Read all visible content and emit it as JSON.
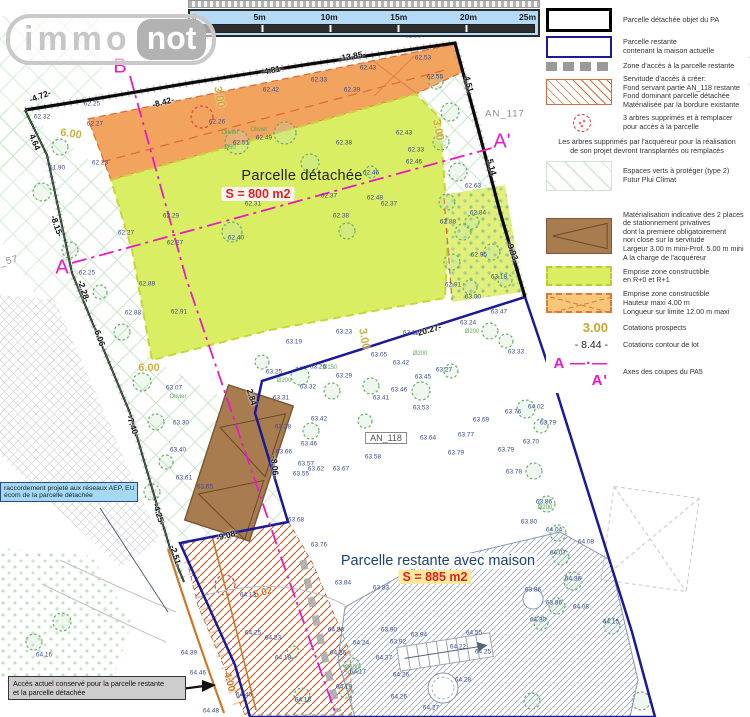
{
  "logo": {
    "immo": "immo",
    "not": "not"
  },
  "scalebar": {
    "ticks": [
      "0",
      "5m",
      "10m",
      "15m",
      "20m",
      "25m"
    ]
  },
  "colors": {
    "detached_boundary": "#000000",
    "remaining_boundary": "#1a1a99",
    "axis_magenta": "#ea18c8",
    "emprise_green": "#d9ee63",
    "emprise_orange": "#f2a35e",
    "servitude_hatch": "#c06838",
    "parking_brown": "#a97c50",
    "prospect_gold": "#c9a62e",
    "spot_blue": "#3c4e8f",
    "area_red": "#e02020"
  },
  "legend": {
    "items": [
      {
        "type": "black",
        "lines": [
          "Parcelle détachée objet du PA"
        ]
      },
      {
        "type": "blue",
        "lines": [
          "Parcelle restante",
          "contenant la maison actuelle"
        ]
      },
      {
        "type": "graydash",
        "lines": [
          "Zone d'accès à la parcelle restante"
        ]
      },
      {
        "type": "hatch",
        "lines": [
          "Servitude d'accès à créer:",
          "Fond servant partie AN_118 restante",
          "Fond dominant parcelle détachée",
          "Matérialisée par la bordure existante"
        ]
      },
      {
        "type": "treered",
        "lines": [
          "3 arbres supprimés et à remplacer",
          "pour accès à la parcelle"
        ]
      },
      {
        "type": "note",
        "lines": [
          "Les arbres supprimés par l'acquéreur pour la réalisation",
          "de son projet devront transplantés ou remplacés"
        ]
      },
      {
        "type": "diamond",
        "gap": true,
        "lines": [
          "Espaces verts à protéger (type 2)",
          "Futur Plui Climat"
        ]
      },
      {
        "type": "parking",
        "lines": [
          "Matérialisation indicative des 2 places",
          "de stationnement privatives",
          "dont la premiere obligatoirement",
          "non close sur la servitude",
          "Largeur 3.00 m mini-Prof. 5.00 m mini",
          "A la charge de l'acquéreur"
        ]
      },
      {
        "type": "greendash",
        "lines": [
          "Emprise zone constructible",
          "en R+0 et R+1"
        ]
      },
      {
        "type": "orangex",
        "lines": [
          "Emprise zone constructible",
          "Hauteur maxi 4.00 m",
          "Longueur sur limite 12.00 m maxi"
        ]
      },
      {
        "type": "gold3",
        "label": "3.00",
        "lines": [
          "Cotations prospects"
        ]
      },
      {
        "type": "cot844",
        "label": "- 8.44 -",
        "lines": [
          "Cotations contour de lot"
        ]
      },
      {
        "type": "axis",
        "label": "A —·— A'",
        "lines": [
          "Axes des coupes du PA5"
        ]
      }
    ]
  },
  "callouts": {
    "network": {
      "lines": [
        "raccordement projeté aux réseaux AEP, EU",
        "écom de la parcelle détachée"
      ]
    },
    "access": {
      "lines": [
        "Accès actuel conservé pour la parcelle restante",
        "et la parcelle détachée"
      ]
    }
  },
  "plan": {
    "labels": [
      [
        "B",
        120,
        67,
        "mag",
        0
      ],
      [
        "A",
        62,
        268,
        "mag",
        0
      ],
      [
        "A'",
        502,
        142,
        "mag",
        0
      ],
      [
        "AN_107",
        280,
        30,
        "pid",
        0
      ],
      [
        "AN_117",
        505,
        114,
        "pid",
        0
      ],
      [
        "AN_57",
        2,
        263,
        "pid",
        -15
      ],
      [
        "AN_118",
        386,
        438,
        "pidbox",
        0
      ],
      [
        "Parcelle détachée",
        302,
        176,
        "t1",
        0
      ],
      [
        "S = 800 m2",
        258,
        194,
        "s1",
        0
      ],
      [
        "Parcelle restante avec maison",
        438,
        561,
        "t2",
        0
      ],
      [
        "S = 885 m2",
        435,
        577,
        "s2",
        0
      ],
      [
        "-4.72-",
        40,
        96,
        "cot",
        -20
      ],
      [
        "-8.42-",
        163,
        102,
        "cot",
        -14
      ],
      [
        "-4.81-",
        272,
        70,
        "cot",
        -11
      ],
      [
        "-13.85-",
        352,
        56,
        "cot",
        -10
      ],
      [
        "4.64",
        35,
        142,
        "cot",
        68
      ],
      [
        "-8.15-",
        57,
        226,
        "cot",
        71
      ],
      [
        "-2.28-",
        84,
        291,
        "cot",
        72
      ],
      [
        "-6.06-",
        100,
        338,
        "cot",
        70
      ],
      [
        "-7.40-",
        133,
        426,
        "cot",
        71
      ],
      [
        "-4.25-",
        159,
        514,
        "cot",
        73
      ],
      [
        "-2.51-",
        176,
        556,
        "cot",
        73
      ],
      [
        "4.51",
        469,
        84,
        "cot",
        76
      ],
      [
        "5.14",
        492,
        167,
        "cot",
        76
      ],
      [
        "-9.93-",
        513,
        252,
        "cot",
        70
      ],
      [
        "-20.27-",
        428,
        330,
        "cot",
        -16
      ],
      [
        "2.84",
        252,
        397,
        "cot",
        73
      ],
      [
        "-8.06-",
        275,
        467,
        "cot",
        84
      ],
      [
        "-9.08-",
        227,
        535,
        "cot",
        -14
      ],
      [
        "3.00",
        219,
        97,
        "gold",
        80
      ],
      [
        "3.00",
        438,
        130,
        "gold",
        80
      ],
      [
        "3.00",
        364,
        339,
        "gold",
        80
      ],
      [
        "6.00",
        71,
        134,
        "gold",
        8
      ],
      [
        "6.00",
        149,
        368,
        "gold",
        0
      ],
      [
        "4.00",
        229,
        682,
        "ocot",
        75
      ],
      [
        "5.02",
        263,
        593,
        "ocot",
        -15
      ],
      [
        "Olivier",
        230,
        133,
        "tl",
        0
      ],
      [
        "Olivier",
        259,
        130,
        "tl",
        0
      ],
      [
        "Olivier",
        178,
        397,
        "tl",
        0
      ],
      [
        "Ø50",
        230,
        148,
        "tl",
        0
      ],
      [
        "Ø150",
        330,
        368,
        "tl",
        0
      ],
      [
        "Ø200",
        284,
        381,
        "tl",
        0
      ],
      [
        "Ø200",
        472,
        332,
        "tl",
        0
      ],
      [
        "Ø100",
        352,
        668,
        "tl",
        0
      ],
      [
        "Ø200",
        545,
        508,
        "tl",
        0
      ],
      [
        "Ø200",
        420,
        354,
        "tl",
        0
      ],
      [
        "62.32",
        42,
        117,
        "spot",
        0
      ],
      [
        "62.25",
        92,
        104,
        "spot",
        0
      ],
      [
        "62.27",
        95,
        124,
        "spot",
        0
      ],
      [
        "62.23",
        100,
        163,
        "spot",
        0
      ],
      [
        "61.90",
        57,
        168,
        "spot",
        0
      ],
      [
        "62.29",
        171,
        216,
        "spot",
        0
      ],
      [
        "62.27",
        126,
        233,
        "spot",
        0
      ],
      [
        "62.27",
        175,
        243,
        "spot",
        0
      ],
      [
        "62.25",
        87,
        273,
        "spot",
        0
      ],
      [
        "62.88",
        147,
        284,
        "spot",
        0
      ],
      [
        "62.88",
        133,
        313,
        "spot",
        0
      ],
      [
        "62.91",
        179,
        312,
        "spot",
        0
      ],
      [
        "62.26",
        217,
        122,
        "spot",
        0
      ],
      [
        "62.51",
        241,
        143,
        "spot",
        0
      ],
      [
        "62.49",
        264,
        138,
        "spot",
        0
      ],
      [
        "62.58",
        413,
        36,
        "spot",
        0
      ],
      [
        "62.51",
        459,
        30,
        "spot",
        0
      ],
      [
        "62.53",
        423,
        58,
        "spot",
        0
      ],
      [
        "62.55",
        435,
        77,
        "spot",
        0
      ],
      [
        "62.43",
        368,
        68,
        "spot",
        0
      ],
      [
        "62.33",
        319,
        80,
        "spot",
        0
      ],
      [
        "62.39",
        352,
        90,
        "spot",
        0
      ],
      [
        "62.42",
        271,
        90,
        "spot",
        0
      ],
      [
        "62.43",
        404,
        133,
        "spot",
        0
      ],
      [
        "62.38",
        344,
        143,
        "spot",
        0
      ],
      [
        "62.33",
        416,
        150,
        "spot",
        0
      ],
      [
        "62.46",
        414,
        162,
        "spot",
        0
      ],
      [
        "62.46",
        371,
        173,
        "spot",
        0
      ],
      [
        "62.37",
        329,
        196,
        "spot",
        0
      ],
      [
        "62.48",
        375,
        198,
        "spot",
        0
      ],
      [
        "62.37",
        389,
        204,
        "spot",
        0
      ],
      [
        "62.31",
        253,
        204,
        "spot",
        0
      ],
      [
        "62.38",
        341,
        216,
        "spot",
        0
      ],
      [
        "62.40",
        236,
        238,
        "spot",
        0
      ],
      [
        "62.63",
        473,
        186,
        "spot",
        0
      ],
      [
        "62.84",
        478,
        213,
        "spot",
        0
      ],
      [
        "62.88",
        448,
        222,
        "spot",
        0
      ],
      [
        "62.95",
        479,
        255,
        "spot",
        0
      ],
      [
        "62.91",
        453,
        285,
        "spot",
        0
      ],
      [
        "63.18",
        499,
        277,
        "spot",
        0
      ],
      [
        "63.00",
        473,
        297,
        "spot",
        0
      ],
      [
        "63.47",
        499,
        312,
        "spot",
        0
      ],
      [
        "63.24",
        468,
        323,
        "spot",
        0
      ],
      [
        "63.33",
        516,
        352,
        "spot",
        0
      ],
      [
        "63.23",
        344,
        332,
        "spot",
        0
      ],
      [
        "63.19",
        294,
        342,
        "spot",
        0
      ],
      [
        "63.25",
        274,
        372,
        "spot",
        0
      ],
      [
        "63.26",
        318,
        367,
        "spot",
        0
      ],
      [
        "63.29",
        344,
        376,
        "spot",
        0
      ],
      [
        "63.05",
        379,
        355,
        "spot",
        0
      ],
      [
        "63.10",
        411,
        333,
        "spot",
        0
      ],
      [
        "63.42",
        401,
        363,
        "spot",
        0
      ],
      [
        "63.45",
        423,
        377,
        "spot",
        0
      ],
      [
        "63.27",
        444,
        370,
        "spot",
        0
      ],
      [
        "63.32",
        308,
        387,
        "spot",
        0
      ],
      [
        "63.46",
        399,
        390,
        "spot",
        0
      ],
      [
        "63.31",
        281,
        398,
        "spot",
        0
      ],
      [
        "63.41",
        381,
        398,
        "spot",
        0
      ],
      [
        "63.53",
        421,
        408,
        "spot",
        0
      ],
      [
        "63.28",
        283,
        427,
        "spot",
        0
      ],
      [
        "63.42",
        319,
        419,
        "spot",
        0
      ],
      [
        "63.46",
        309,
        444,
        "spot",
        0
      ],
      [
        "63.69",
        481,
        420,
        "spot",
        0
      ],
      [
        "63.64",
        428,
        438,
        "spot",
        0
      ],
      [
        "63.77",
        466,
        435,
        "spot",
        0
      ],
      [
        "63.79",
        456,
        453,
        "spot",
        0
      ],
      [
        "63.58",
        373,
        457,
        "spot",
        0
      ],
      [
        "63.57",
        306,
        464,
        "spot",
        0
      ],
      [
        "63.62",
        316,
        469,
        "spot",
        0
      ],
      [
        "63.55",
        301,
        474,
        "spot",
        0
      ],
      [
        "63.67",
        341,
        469,
        "spot",
        0
      ],
      [
        "63.66",
        284,
        452,
        "spot",
        0
      ],
      [
        "63.61",
        184,
        478,
        "spot",
        0
      ],
      [
        "63.65",
        205,
        487,
        "spot",
        0
      ],
      [
        "63.68",
        296,
        520,
        "spot",
        0
      ],
      [
        "63.76",
        319,
        545,
        "spot",
        0
      ],
      [
        "63.07",
        174,
        388,
        "spot",
        0
      ],
      [
        "63.30",
        181,
        423,
        "spot",
        0
      ],
      [
        "63.40",
        178,
        450,
        "spot",
        0
      ],
      [
        "64.16",
        44,
        655,
        "spot",
        0
      ],
      [
        "64.39",
        189,
        653,
        "spot",
        0
      ],
      [
        "64.46",
        198,
        673,
        "spot",
        0
      ],
      [
        "64.48",
        211,
        711,
        "spot",
        0
      ],
      [
        "63.76",
        513,
        412,
        "spot",
        0
      ],
      [
        "64.02",
        536,
        407,
        "spot",
        0
      ],
      [
        "63.79",
        548,
        423,
        "spot",
        0
      ],
      [
        "63.70",
        531,
        442,
        "spot",
        0
      ],
      [
        "63.79",
        506,
        450,
        "spot",
        0
      ],
      [
        "63.78",
        514,
        472,
        "spot",
        0
      ],
      [
        "63.86",
        544,
        502,
        "spot",
        0
      ],
      [
        "63.80",
        529,
        522,
        "spot",
        0
      ],
      [
        "64.04",
        554,
        530,
        "spot",
        0
      ],
      [
        "64.08",
        586,
        542,
        "spot",
        0
      ],
      [
        "64.07",
        558,
        553,
        "spot",
        0
      ],
      [
        "64.36",
        573,
        579,
        "spot",
        0
      ],
      [
        "63.86",
        533,
        590,
        "spot",
        0
      ],
      [
        "63.86",
        554,
        603,
        "spot",
        0
      ],
      [
        "64.08",
        581,
        607,
        "spot",
        0
      ],
      [
        "64.30",
        538,
        620,
        "spot",
        0
      ],
      [
        "64.15",
        611,
        622,
        "spot",
        0
      ],
      [
        "63.84",
        343,
        583,
        "spot",
        0
      ],
      [
        "63.83",
        381,
        588,
        "spot",
        0
      ],
      [
        "64.13",
        248,
        595,
        "spot",
        0
      ],
      [
        "64.25",
        253,
        633,
        "spot",
        0
      ],
      [
        "64.23",
        273,
        638,
        "spot",
        0
      ],
      [
        "64.18",
        283,
        658,
        "spot",
        0
      ],
      [
        "64.26",
        338,
        653,
        "spot",
        0
      ],
      [
        "64.17",
        358,
        672,
        "spot",
        0
      ],
      [
        "64.19",
        344,
        687,
        "spot",
        0
      ],
      [
        "64.18",
        303,
        700,
        "spot",
        0
      ],
      [
        "64.40",
        244,
        695,
        "spot",
        0
      ],
      [
        "64.24",
        361,
        643,
        "spot",
        0
      ],
      [
        "64.58",
        336,
        630,
        "spot",
        0
      ],
      [
        "64.37",
        384,
        658,
        "spot",
        0
      ],
      [
        "63.90",
        389,
        630,
        "spot",
        0
      ],
      [
        "63.92",
        398,
        642,
        "spot",
        0
      ],
      [
        "63.94",
        419,
        635,
        "spot",
        0
      ],
      [
        "64.55",
        474,
        633,
        "spot",
        0
      ],
      [
        "64.22",
        458,
        647,
        "spot",
        0
      ],
      [
        "64.25",
        483,
        652,
        "spot",
        0
      ],
      [
        "64.26",
        401,
        675,
        "spot",
        0
      ],
      [
        "64.28",
        463,
        680,
        "spot",
        0
      ],
      [
        "64.26",
        399,
        697,
        "spot",
        0
      ],
      [
        "64.27",
        431,
        708,
        "spot",
        0
      ]
    ]
  }
}
